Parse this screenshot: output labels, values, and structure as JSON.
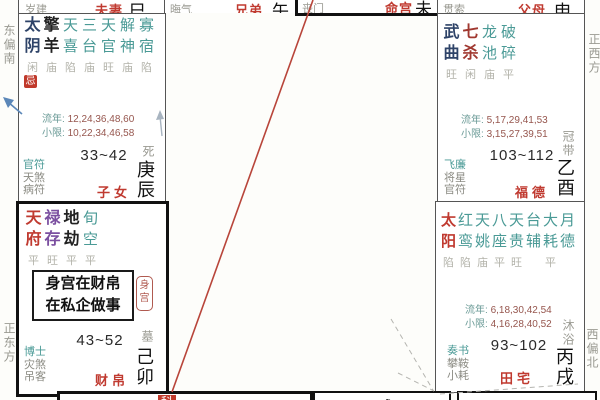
{
  "colors": {
    "palace_name_red": "#c03a30",
    "minor_star_teal": "#4a9a96",
    "main_star_navy": "#2e4368",
    "main_star_darkred": "#a03830",
    "main_star_purple": "#7b4fa0",
    "brightness_gray": "#b3b3aa",
    "label_gray": "#9a9a92",
    "number_maroon": "#96564e",
    "hua_badge_red": "#c0392b",
    "transit_line_red": "#b8453a",
    "arrow_blue": "#5b87b8",
    "border_dark": "#1a1a1a"
  },
  "compass": {
    "top_left": "东偏南",
    "bottom_left": "正东方",
    "top_right": "正西方",
    "bottom_right": "西偏北"
  },
  "top_strip": [
    {
      "minor_star": "岁建",
      "palace": "夫妻",
      "branch": "巳"
    },
    {
      "minor_star": "晦气",
      "palace": "兄弟",
      "branch": "午"
    },
    {
      "minor_star": "丧门",
      "palace": "命宫",
      "branch": "未"
    },
    {
      "minor_star": "贯索",
      "palace": "父母",
      "branch": "申"
    }
  ],
  "palaces": [
    {
      "name": "子女",
      "ganzhi": "庚辰",
      "changsheng": "死",
      "age_range": "33~42",
      "hua": "忌",
      "liunian_label": "流年:",
      "liunian": "12,24,36,48,60",
      "xiaoxian_label": "小限:",
      "xiaoxian": "10,22,34,46,58",
      "columns": [
        {
          "star": "太阴",
          "bright": "闲"
        },
        {
          "star": "擎羊",
          "bright": "庙"
        },
        {
          "star": "天喜",
          "bright": "陷"
        },
        {
          "star": "三台",
          "bright": "庙"
        },
        {
          "star": "天官",
          "bright": "旺"
        },
        {
          "star": "解神",
          "bright": "庙"
        },
        {
          "star": "寡宿",
          "bright": "陷"
        }
      ],
      "left_stars": [
        "官符",
        "天煞",
        "病符"
      ]
    },
    {
      "name": "财帛",
      "ganzhi": "己卯",
      "changsheng": "墓",
      "age_range": "43~52",
      "note_line1": "身宫在财帛",
      "note_line2": "在私企做事",
      "body_badge": "身宫",
      "columns": [
        {
          "star": "天府",
          "bright": "平"
        },
        {
          "star": "禄存",
          "bright": "旺"
        },
        {
          "star": "地劫",
          "bright": "平"
        },
        {
          "star": "旬空",
          "bright": "平"
        }
      ],
      "left_stars": [
        "博士",
        "灾煞",
        "吊客"
      ]
    },
    {
      "name": "福德",
      "ganzhi": "乙酉",
      "changsheng": "冠带",
      "age_range": "103~112",
      "liunian_label": "流年:",
      "liunian": "5,17,29,41,53",
      "xiaoxian_label": "小限:",
      "xiaoxian": "3,15,27,39,51",
      "columns": [
        {
          "star": "武曲",
          "bright": "旺"
        },
        {
          "star": "七杀",
          "bright": "闲"
        },
        {
          "star": "龙池",
          "bright": "庙"
        },
        {
          "star": "破碎",
          "bright": "平"
        }
      ],
      "left_stars": [
        "飞廉",
        "将星",
        "官符"
      ]
    },
    {
      "name": "田宅",
      "ganzhi": "丙戌",
      "changsheng": "沐浴",
      "age_range": "93~102",
      "liunian_label": "流年:",
      "liunian": "6,18,30,42,54",
      "xiaoxian_label": "小限:",
      "xiaoxian": "4,16,28,40,52",
      "columns": [
        {
          "star": "太阳",
          "bright": "陷"
        },
        {
          "star": "红鸾",
          "bright": "陷"
        },
        {
          "star": "天姚",
          "bright": "庙"
        },
        {
          "star": "八座",
          "bright": "平"
        },
        {
          "star": "天贵",
          "bright": "旺"
        },
        {
          "star": "台辅",
          "bright": ""
        },
        {
          "star": "大耗",
          "bright": "平"
        },
        {
          "star": "月德",
          "bright": ""
        }
      ],
      "left_stars": [
        "奏书",
        "攀鞍",
        "小耗"
      ]
    }
  ],
  "bottom_row": {
    "box1_left_partial": "陀铃天天",
    "box1_badge_partial": "科",
    "box1_right_partial": "天左天天年",
    "box2_partial": "天天天咸",
    "box3_partial": "天马"
  }
}
